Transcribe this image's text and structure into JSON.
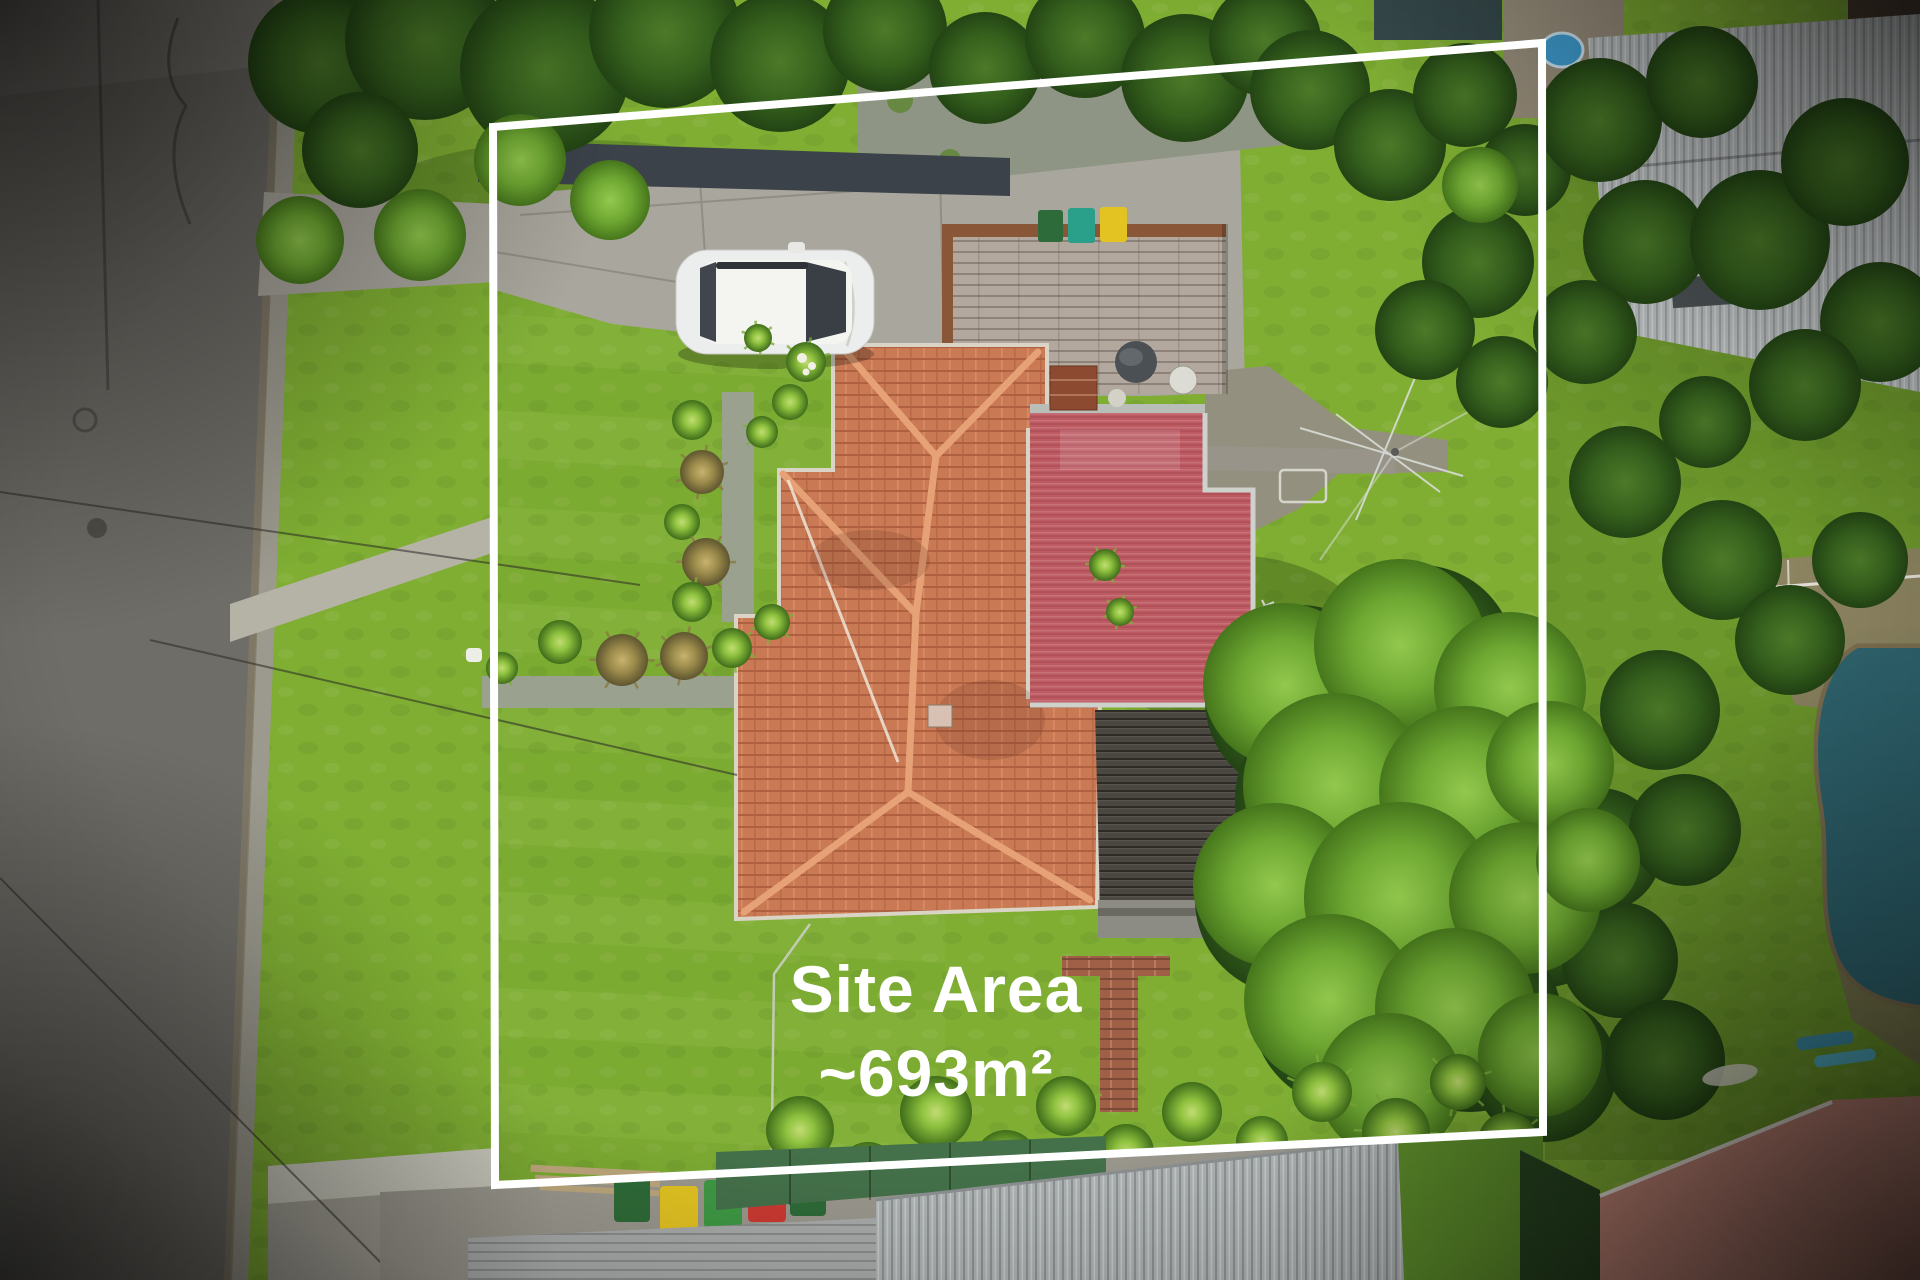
{
  "overlay": {
    "site_area_label": "Site Area",
    "site_area_value": "~693m²",
    "text_color": "#ffffff",
    "boundary_color": "#ffffff"
  },
  "scene": {
    "type": "aerial-drone-photo",
    "palette": {
      "lawn": "#7fae33",
      "lawn_bright": "#8fc23f",
      "roof_tiles": "#c97a54",
      "roof_metal_red": "#bd5a62",
      "deck_timber": "#b3a89e",
      "deck_dark": "#4b4741",
      "road_asphalt": "#6f6d67",
      "concrete": "#a9a69d",
      "pool_water": "#2f6570",
      "tree_bright": "#7cb43e",
      "tree_dark": "#35601d",
      "car_body": "#eceded",
      "bin_yellow": "#e3c322",
      "bin_green": "#3e9a44",
      "bin_red": "#cc3a32",
      "kiddie_pool_blue": "#3f9fd4"
    }
  }
}
